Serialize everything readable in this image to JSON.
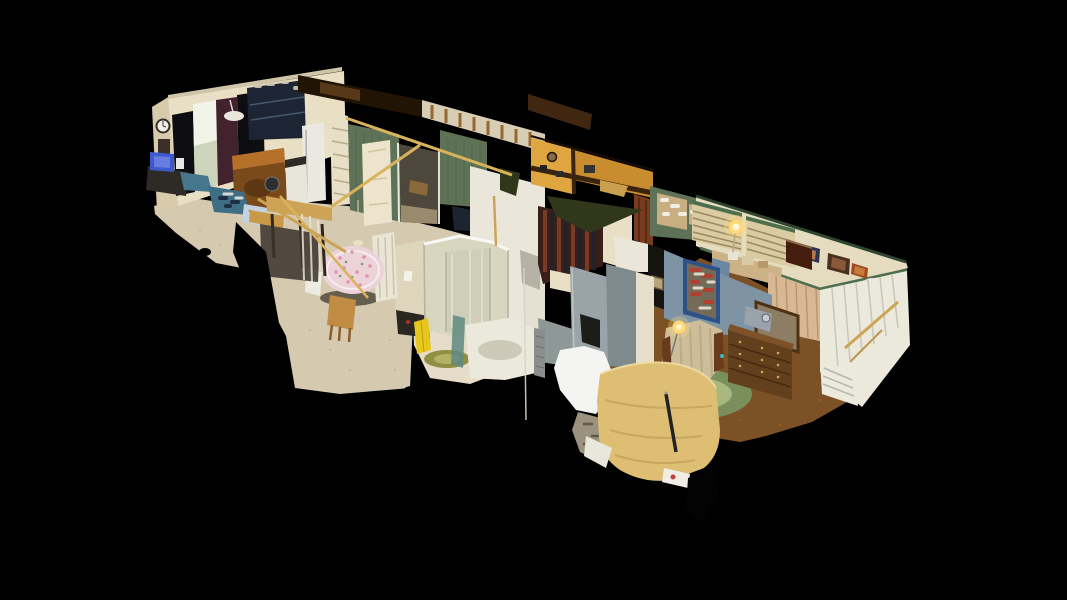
{
  "viewer": {
    "type": "dollhouse-3d-scan",
    "rooms": [
      "living-room",
      "kitchen",
      "dining-area",
      "hallway",
      "bathroom",
      "bedroom"
    ]
  },
  "canvas": {
    "width": 1067,
    "height": 600,
    "background": "#000000"
  },
  "palette": {
    "background": "#000000",
    "carpet": "#d5cab0",
    "bathFloor": "#e5ddc7",
    "carpetBrown": "#7c5126",
    "wallCream": "#e9dfc4",
    "wallCreamDark": "#d8cbab",
    "wallWhite": "#eae6d9",
    "grayPanel": "#b5b1a4",
    "stucco": "#d6cdb4",
    "stud": "#96682f",
    "roofDark": "#221405",
    "roofBrown": "#60401e",
    "roofSliver": "#3f2712",
    "sage": "#5e7257",
    "trimGreen": "#4e6f4e",
    "trimGreenDark": "#2e4630",
    "cork": "#c8ae80",
    "blinds": "#dbcba2",
    "blindsLine": "#9a8a62",
    "orange": "#c98c2e",
    "orangeLight": "#dfa63f",
    "trimBrown": "#3a2410",
    "olive": "#31371a",
    "curtainBlack": "#0e0e12",
    "maroon": "#42222c",
    "windowLight": "#ccd4bc",
    "windowBright": "#f2f4ea",
    "navy": "#1d2433",
    "fridge": "#e9e9e1",
    "hutchOrange": "#b5702a",
    "hutchBrown": "#7b4a1b",
    "beam": "#cda455",
    "beamGold": "#d9b35c",
    "teal": "#46778c",
    "screenBlue": "#3d59cf",
    "slate": "#7e93a3",
    "shelfBlue": "#2e5288",
    "dresser": "#63401d",
    "floral": "#cdbd98",
    "glow": "#ffd977",
    "panelWhite": "#ebe8dc",
    "panelTan": "#d8b894",
    "plateBlue": "#655a94",
    "clothPink": "#ecd3da",
    "pinkDot": "#df93ad",
    "woodChair": "#c08c43",
    "whitePatch": "#f4f4f2",
    "gray1": "#8e9896",
    "gray2": "#9aa4a8",
    "gray3": "#7e8a8c",
    "yellow": "#e8c71d",
    "shower": "#d9d6c0",
    "bedKhaki": "#ddbe73",
    "bedShade": "#c3a159",
    "rugGreen": "#7b8f5c",
    "rugOlive": "#8f8f42",
    "doorWood": "#7a3c1e",
    "chestDark": "#451d0e",
    "debris": "#9a927e"
  }
}
